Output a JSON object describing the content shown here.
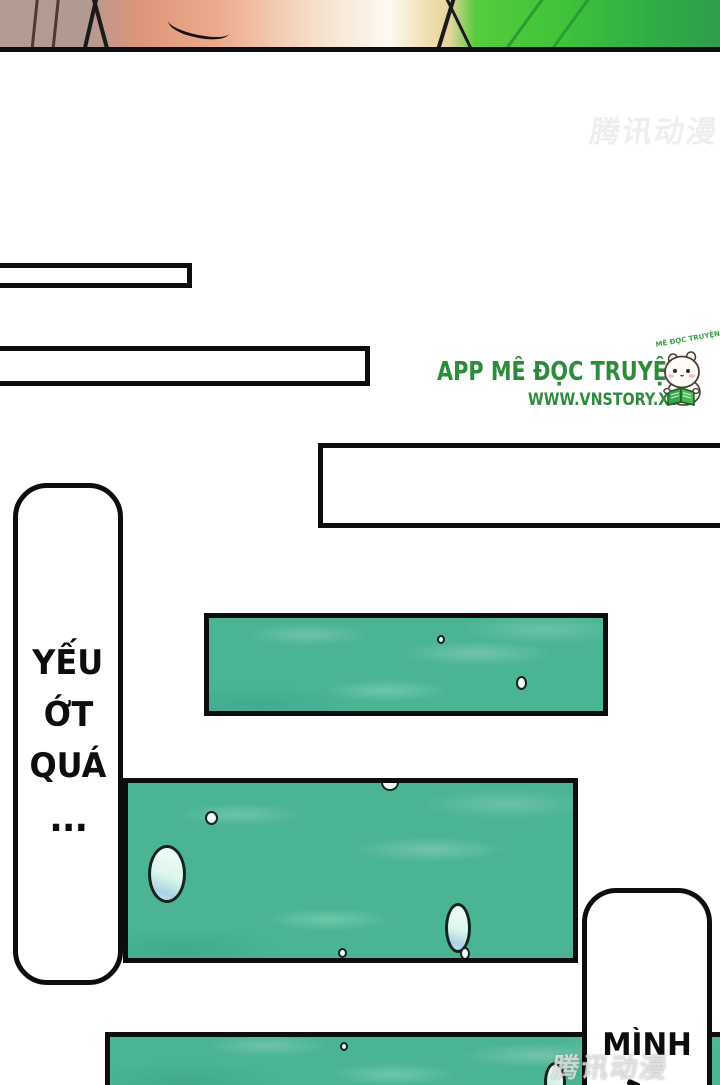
{
  "watermarks": {
    "top_right": "腾讯动漫",
    "bottom_right": "腾讯动漫"
  },
  "logo": {
    "app_title": "APP MÊ ĐỌC TRUYỆN",
    "website": "WWW.VNSTORY.XYZ",
    "mascot_caption": "MÊ ĐỌC TRUYỆN",
    "title_color": "#2e8b3c"
  },
  "bubbles": {
    "left": {
      "line1": "YẾU",
      "line2": "ỚT",
      "line3": "QUÁ",
      "ellipsis": "..."
    },
    "bottom_right": {
      "line1": "MÌNH"
    }
  },
  "colors": {
    "water_teal": "#4bb495",
    "outline_black": "#0d0d0d",
    "droplet_mint": "#ddf6ec",
    "droplet_blue": "#a9d3e4",
    "logo_green": "#2e8b3c",
    "strip_salmon": "#eda98b",
    "strip_taupe": "#b49c93",
    "strip_leaf_green": "#3fc439"
  }
}
